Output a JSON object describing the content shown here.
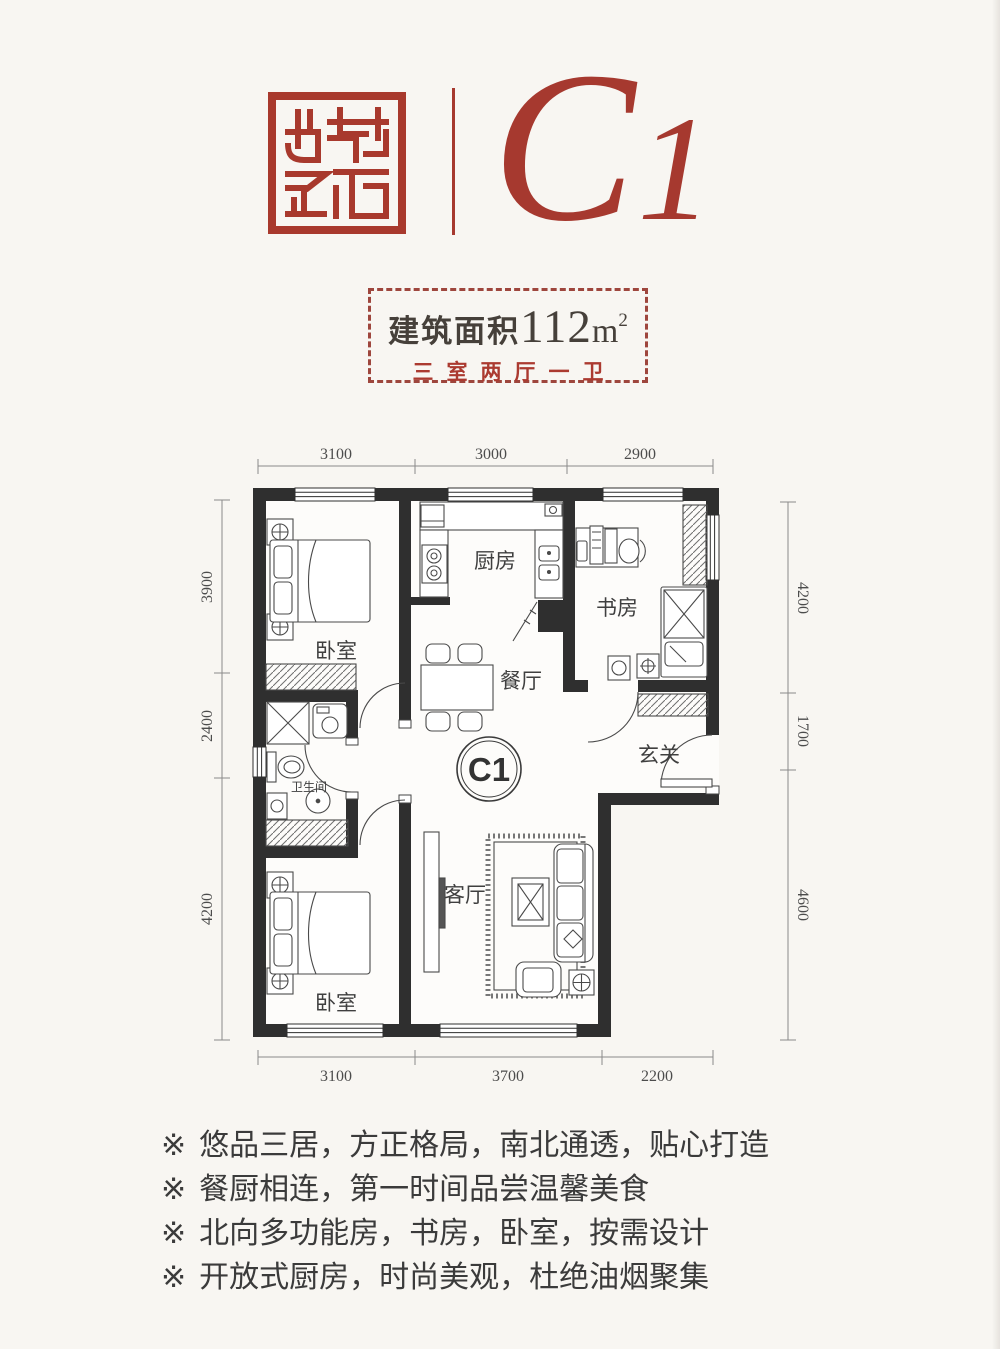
{
  "colors": {
    "accent": "#a6392f",
    "seal_red": "#a8392d",
    "wall": "#2f2f2f"
  },
  "header": {
    "logo_icon": "brand-seal",
    "unit_major": "C",
    "unit_minor": "1"
  },
  "area_box": {
    "area_label": "建筑面积",
    "area_value": "112",
    "area_unit": "m",
    "area_exponent": "2",
    "layout_text": "三室两厅一卫"
  },
  "floorplan": {
    "badge": "C1",
    "rooms": {
      "bedroom_north": "卧室",
      "kitchen": "厨房",
      "study": "书房",
      "dining": "餐厅",
      "bathroom": "卫生间",
      "foyer": "玄关",
      "living": "客厅",
      "bedroom_south": "卧室"
    },
    "dims": {
      "top": [
        "3100",
        "3000",
        "2900"
      ],
      "bottom": [
        "3100",
        "3700",
        "2200"
      ],
      "left": [
        "3900",
        "2400",
        "4200"
      ],
      "right": [
        "4200",
        "1700",
        "4600"
      ]
    }
  },
  "features": [
    {
      "marker": "※",
      "text": "悠品三居，方正格局，南北通透，贴心打造"
    },
    {
      "marker": "※",
      "text": "餐厨相连，第一时间品尝温馨美食"
    },
    {
      "marker": "※",
      "text": "北向多功能房，书房，卧室，按需设计"
    },
    {
      "marker": "※",
      "text": "开放式厨房，时尚美观，杜绝油烟聚集"
    }
  ]
}
